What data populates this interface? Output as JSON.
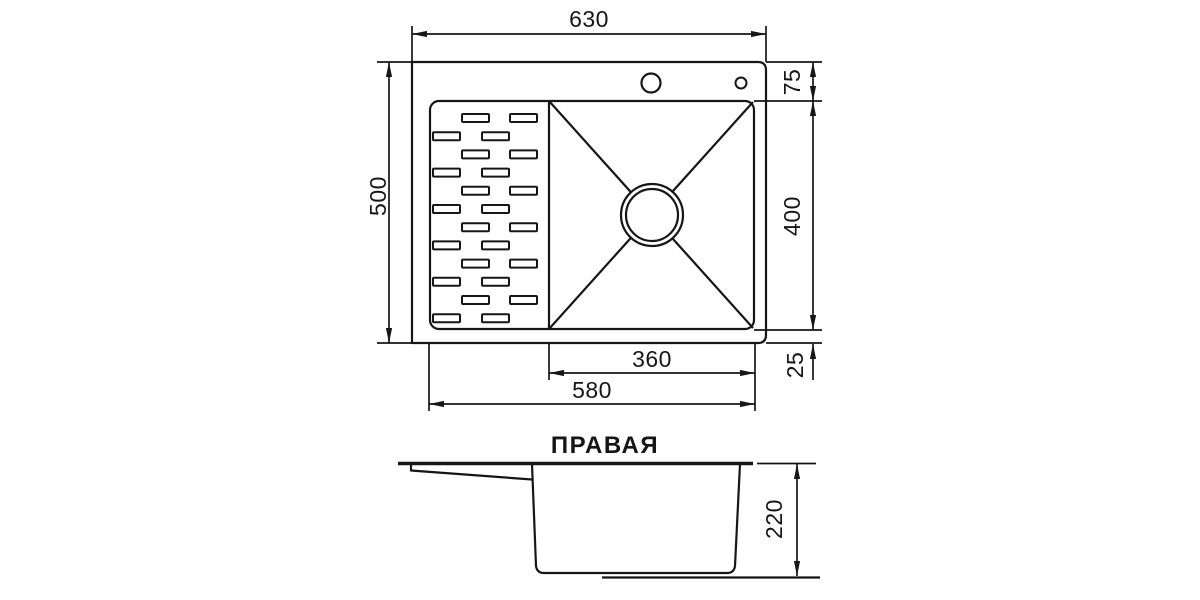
{
  "figure": {
    "title": "ПРАВАЯ",
    "colors": {
      "line": "#161616",
      "background": "#ffffff"
    },
    "top_view": {
      "dims": {
        "overall_width": "630",
        "overall_depth": "500",
        "back_ledge": "75",
        "bowl_depth": "400",
        "front_ledge": "25",
        "bowl_width": "360",
        "inner_width": "580"
      }
    },
    "side_view": {
      "dims": {
        "height": "220"
      }
    }
  }
}
